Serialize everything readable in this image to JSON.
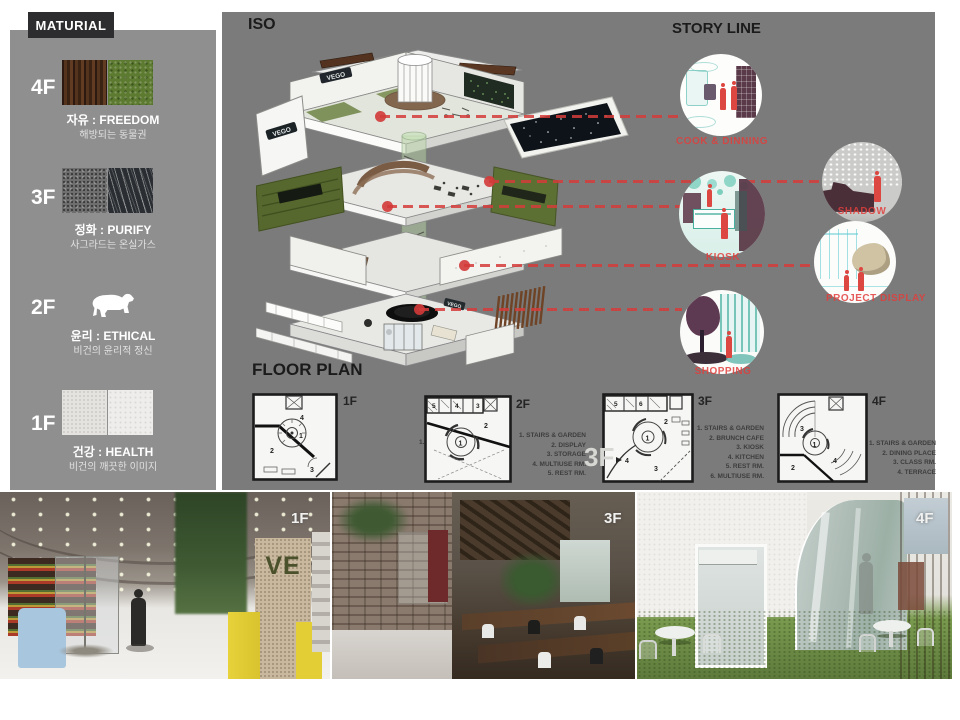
{
  "sidebar": {
    "title": "MATURIAL",
    "floors": [
      {
        "label": "4F",
        "keyword": "자유 : FREEDOM",
        "desc": "해방되는 동물권"
      },
      {
        "label": "3F",
        "keyword": "정화 : PURIFY",
        "desc": "사그라드는 온실가스"
      },
      {
        "label": "2F",
        "keyword": "윤리 : ETHICAL",
        "desc": "비건의 윤리적 정신"
      },
      {
        "label": "1F",
        "keyword": "건강 : HEALTH",
        "desc": "비건의 깨끗한 이미지"
      }
    ]
  },
  "iso": {
    "title": "ISO",
    "building_sign": "VEGO"
  },
  "story_line": {
    "title": "STORY LINE",
    "items": [
      {
        "label": "COOK & DINNING"
      },
      {
        "label": "SHADOW"
      },
      {
        "label": "KIOSK"
      },
      {
        "label": "PROJECT DISPLAY"
      },
      {
        "label": "SHOPPING"
      }
    ]
  },
  "floor_plans": {
    "title": "FLOOR PLAN",
    "overlay_label": "3F",
    "plans": [
      {
        "label": "1F",
        "legend": [
          "1. STAIRS & GARDEN",
          "2. DISPLAY",
          "3. MAIN ENT.",
          "4. SUB ENT."
        ],
        "markers": [
          "1",
          "2",
          "3",
          "4"
        ]
      },
      {
        "label": "2F",
        "legend": [
          "1. STAIRS & GARDEN",
          "2. DISPLAY",
          "3. STORAGE",
          "4. MULTIUSE RM.",
          "5. REST RM."
        ],
        "markers": [
          "1",
          "2",
          "3",
          "4",
          "5"
        ]
      },
      {
        "label": "3F",
        "legend": [
          "1. STAIRS & GARDEN",
          "2. BRUNCH CAFE",
          "3. KIOSK",
          "4. KITCHEN",
          "5. REST RM.",
          "6. MULTIUSE RM."
        ],
        "markers": [
          "1",
          "2",
          "3",
          "4",
          "5",
          "6"
        ]
      },
      {
        "label": "4F",
        "legend": [
          "1. STAIRS & GARDEN",
          "2. DINING PLACE",
          "3. CLASS RM.",
          "4. TERRACE"
        ],
        "markers": [
          "1",
          "2",
          "3",
          "4"
        ]
      }
    ]
  },
  "photos": [
    {
      "label": "1F",
      "sign": "VE"
    },
    {
      "label": "3F"
    },
    {
      "label": "4F"
    }
  ],
  "colors": {
    "accent_red": "#dd4742",
    "panel_gray": "#7b7b7b",
    "sidebar_gray": "#8f8f8f"
  }
}
